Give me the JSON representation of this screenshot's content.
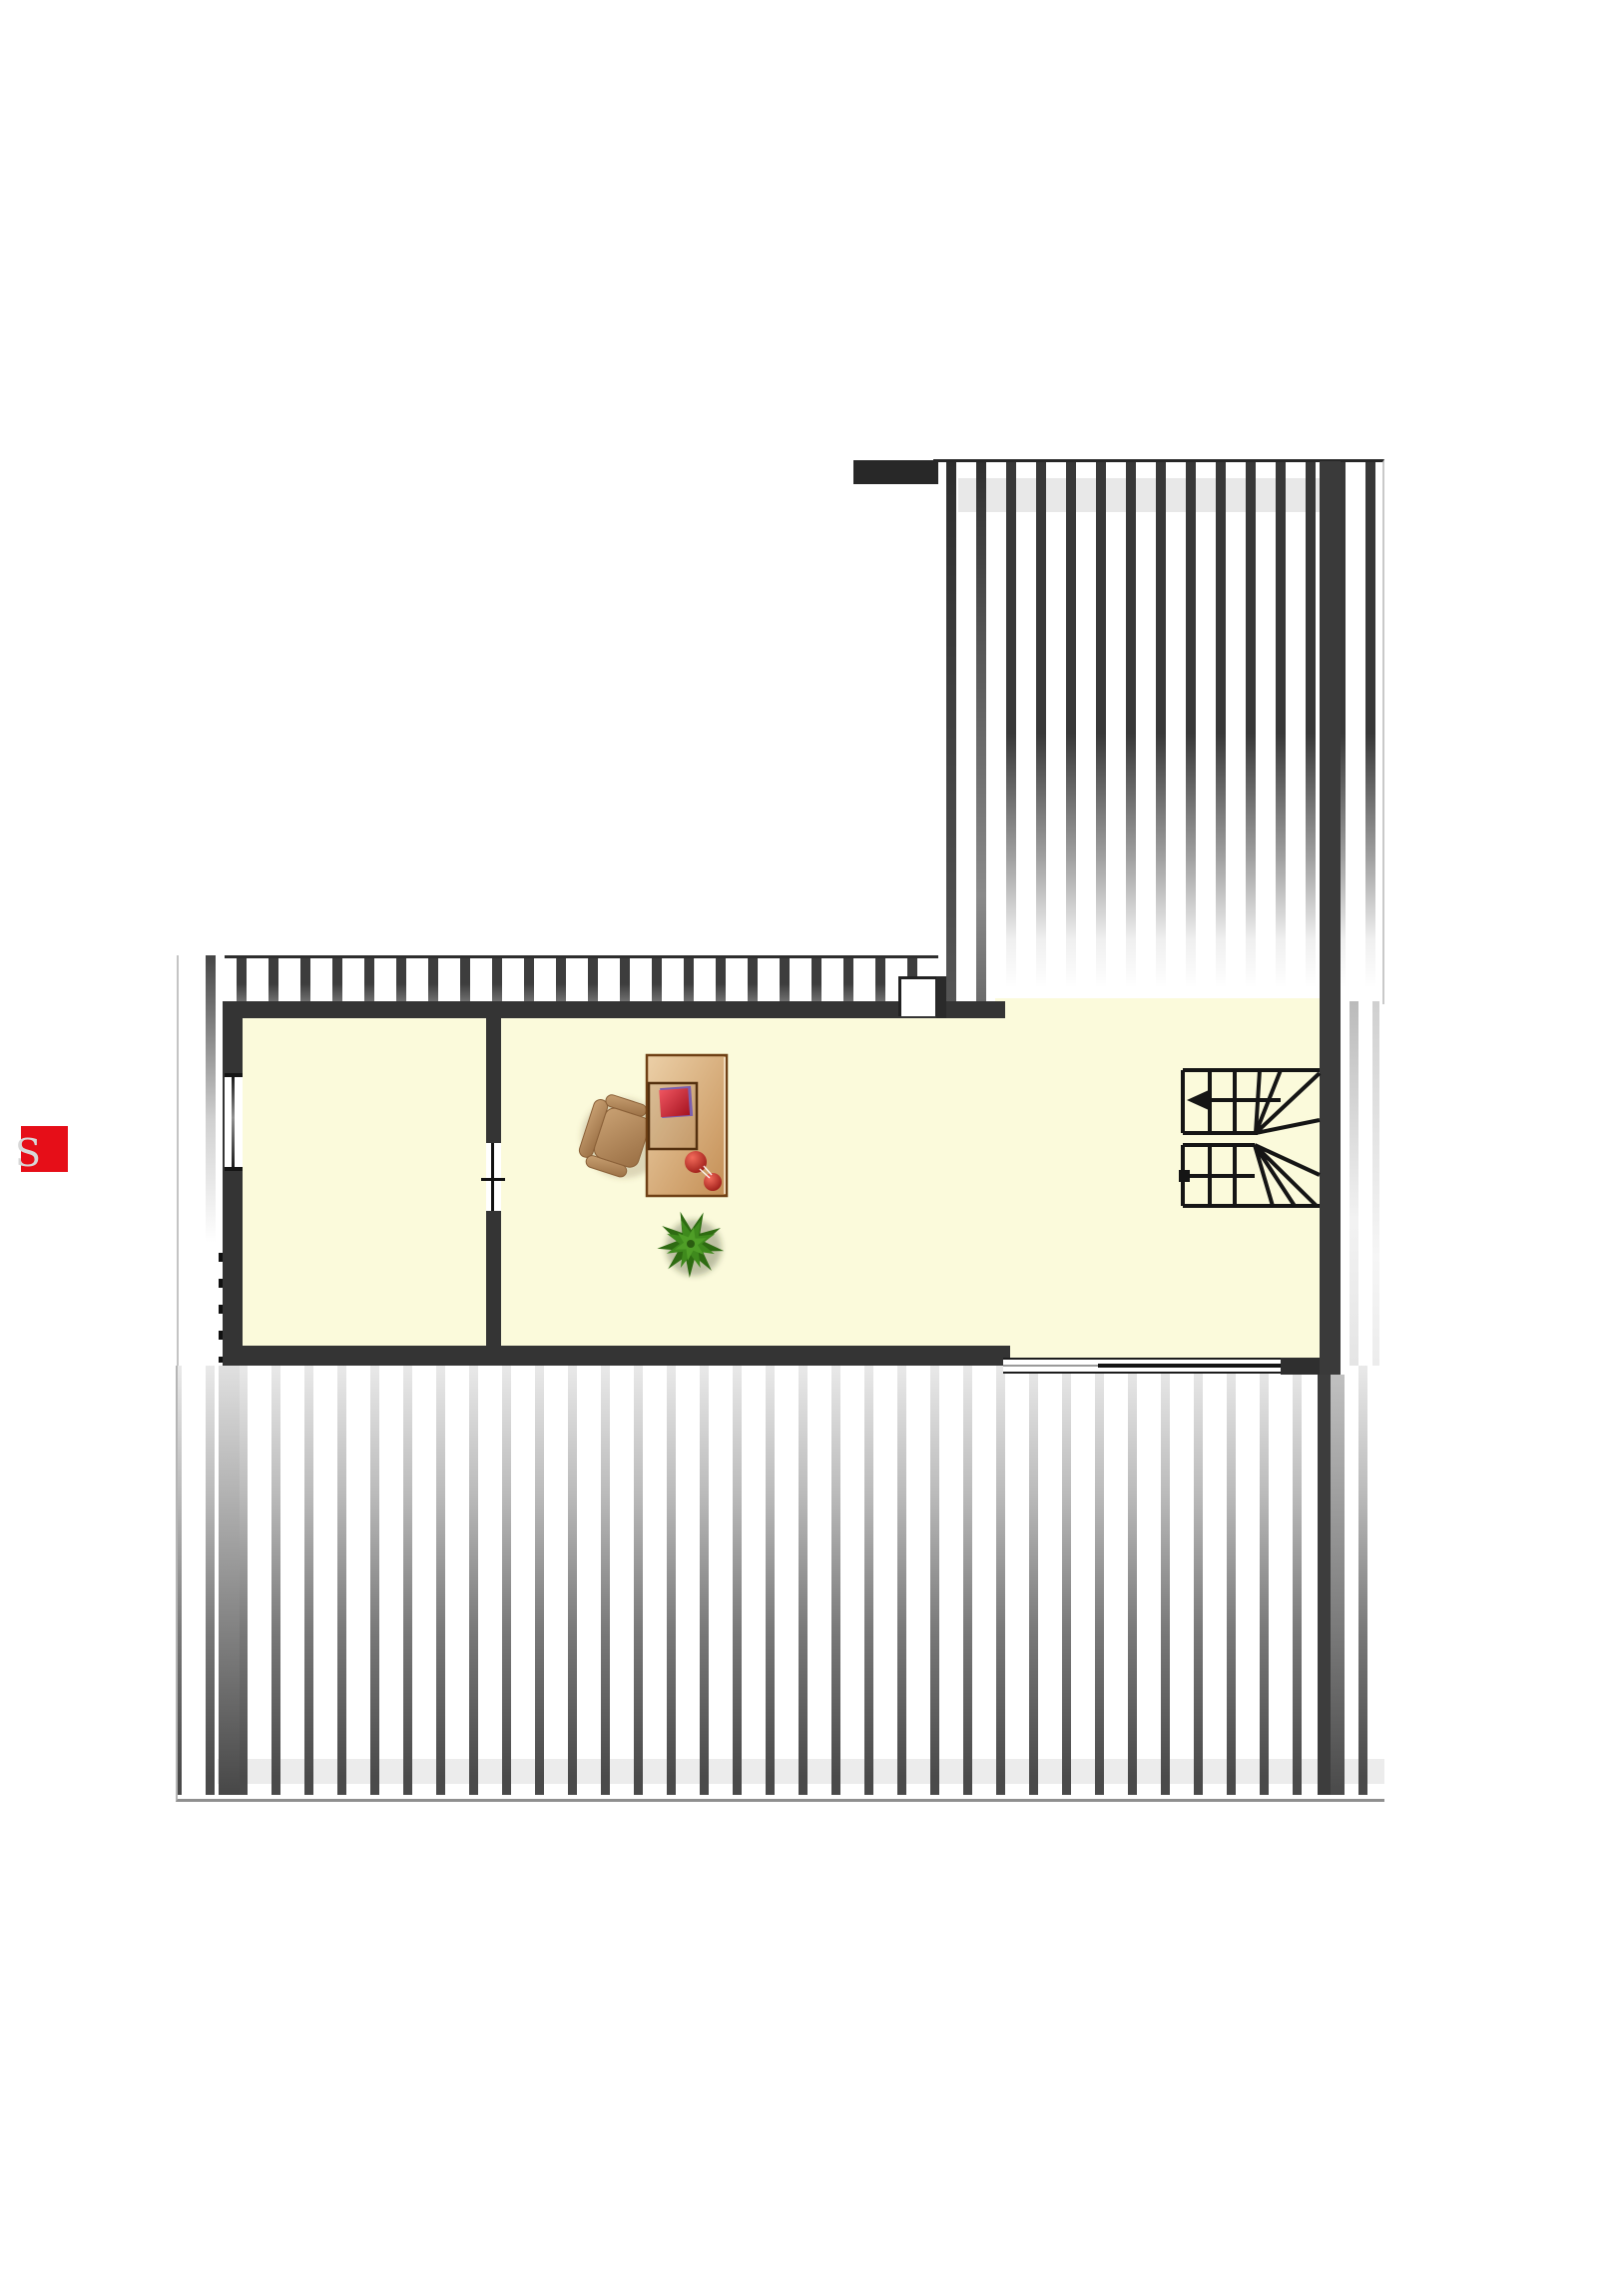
{
  "legend_badge": {
    "letter": "S",
    "square_color": "#e60e18",
    "letter_color": "#d7d7d7"
  },
  "palette": {
    "background": "#ffffff",
    "wall": "#343434",
    "wall_dark": "#272727",
    "floor_cream": "#fbfadb",
    "roof_stripe_dark": "#3d3d3d",
    "roof_stripe_light": "#d9d9d9",
    "stair_line": "#151515",
    "desk_wood_light": "#ecd0a8",
    "desk_wood": "#c48e54",
    "desk_border": "#6f4015",
    "chair_wood": "#c9a173",
    "book_red": "#d8333f",
    "book_purple": "#7b5fae",
    "apple_red": "#c42b22",
    "plant_green_dark": "#2e6b12",
    "plant_green_mid": "#3f8a1d",
    "plant_green_light": "#4f9e27"
  },
  "objects": {
    "staircase": "u-shaped stair with winder treads",
    "stair_arrow_direction": "left",
    "desk": "desk with red book stack and two red apples",
    "chair": "desk chair",
    "plant": "green potted plant (top view)",
    "left_wall_window": "window",
    "top_wall_window": "window",
    "bottom_glazing": "window band",
    "middle_door": "door opening",
    "roof_hatching": "sloped roof areas (striped)"
  }
}
